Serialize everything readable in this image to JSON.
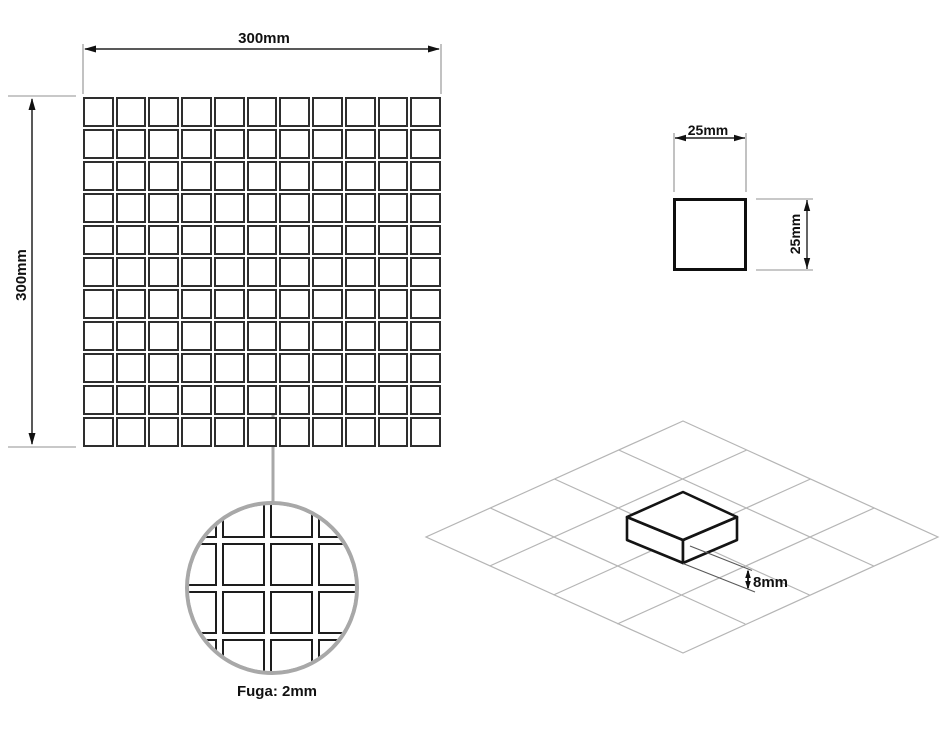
{
  "labels": {
    "sheet_width": "300mm",
    "sheet_height": "300mm",
    "tile_width": "25mm",
    "tile_height": "25mm",
    "grout": "Fuga: 2mm",
    "thickness": "8mm"
  },
  "sheet": {
    "columns": 11,
    "rows": 11
  },
  "magnifier": {
    "columns": 5,
    "rows": 5
  },
  "iso_grid": {
    "columns": 4,
    "rows": 4
  },
  "colors": {
    "drawing_line": "#141414",
    "tile_border": "#2e2e2e",
    "dimension_line": "#222222",
    "extension_line": "#909090",
    "callout_gray": "#a8a8a8",
    "iso_grid_line": "#b5b5b5",
    "background": "#ffffff"
  }
}
